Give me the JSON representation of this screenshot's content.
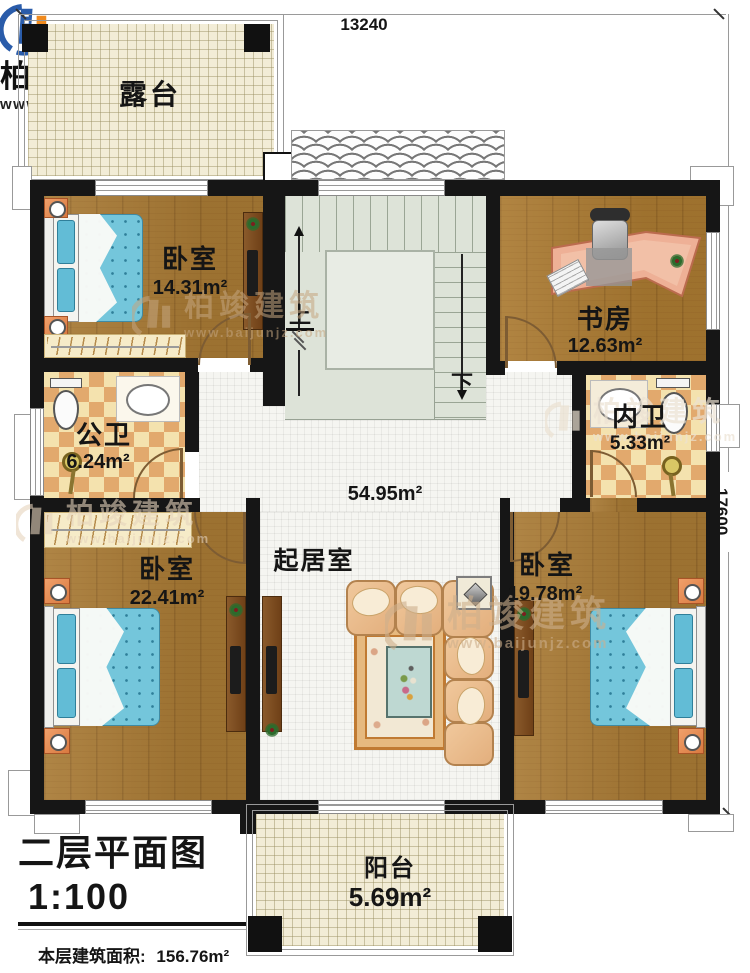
{
  "meta": {
    "title": "二层平面图",
    "scale": "1:100",
    "floor_area_label": "本层建筑面积:",
    "floor_area_value": "156.76m²",
    "floor_height_label": "层高:",
    "floor_height_value": "3.3m"
  },
  "dimensions": {
    "top_width": "13240",
    "right_height": "17600"
  },
  "rooms": {
    "terrace": {
      "name": "露台"
    },
    "bedroom_top_left": {
      "name": "卧室",
      "area": "14.31m²"
    },
    "study": {
      "name": "书房",
      "area": "12.63m²"
    },
    "public_bath": {
      "name": "公卫",
      "area": "6.24m²"
    },
    "ensuite_bath": {
      "name": "内卫",
      "area": "5.33m²"
    },
    "living": {
      "name": "起居室",
      "area": "54.95m²"
    },
    "bedroom_bottom_left": {
      "name": "卧室",
      "area": "22.41m²"
    },
    "bedroom_bottom_right": {
      "name": "卧室",
      "area": "19.78m²"
    },
    "balcony": {
      "name": "阳台",
      "area": "5.69m²"
    }
  },
  "stairs": {
    "up_label": "上",
    "down_label": "下"
  },
  "brand": {
    "name": "柏竣建筑",
    "website": "www.baijunjz.com"
  },
  "watermark": {
    "name": "柏竣建筑",
    "website": "www.baijunjz.com"
  },
  "colors": {
    "wall": "#161616",
    "wood_floor": "#a87a35",
    "checker_tile_dark": "#e2a96d",
    "checker_tile_light": "#f4e2ae",
    "hall_tile": "#f5f5f1",
    "terrace_floor": "#f2ecd6",
    "stair_floor": "#dde3d8",
    "bed_blue": "#74c6db",
    "brand_blue": "#2a5caa",
    "brand_orange": "#f08a1d"
  }
}
